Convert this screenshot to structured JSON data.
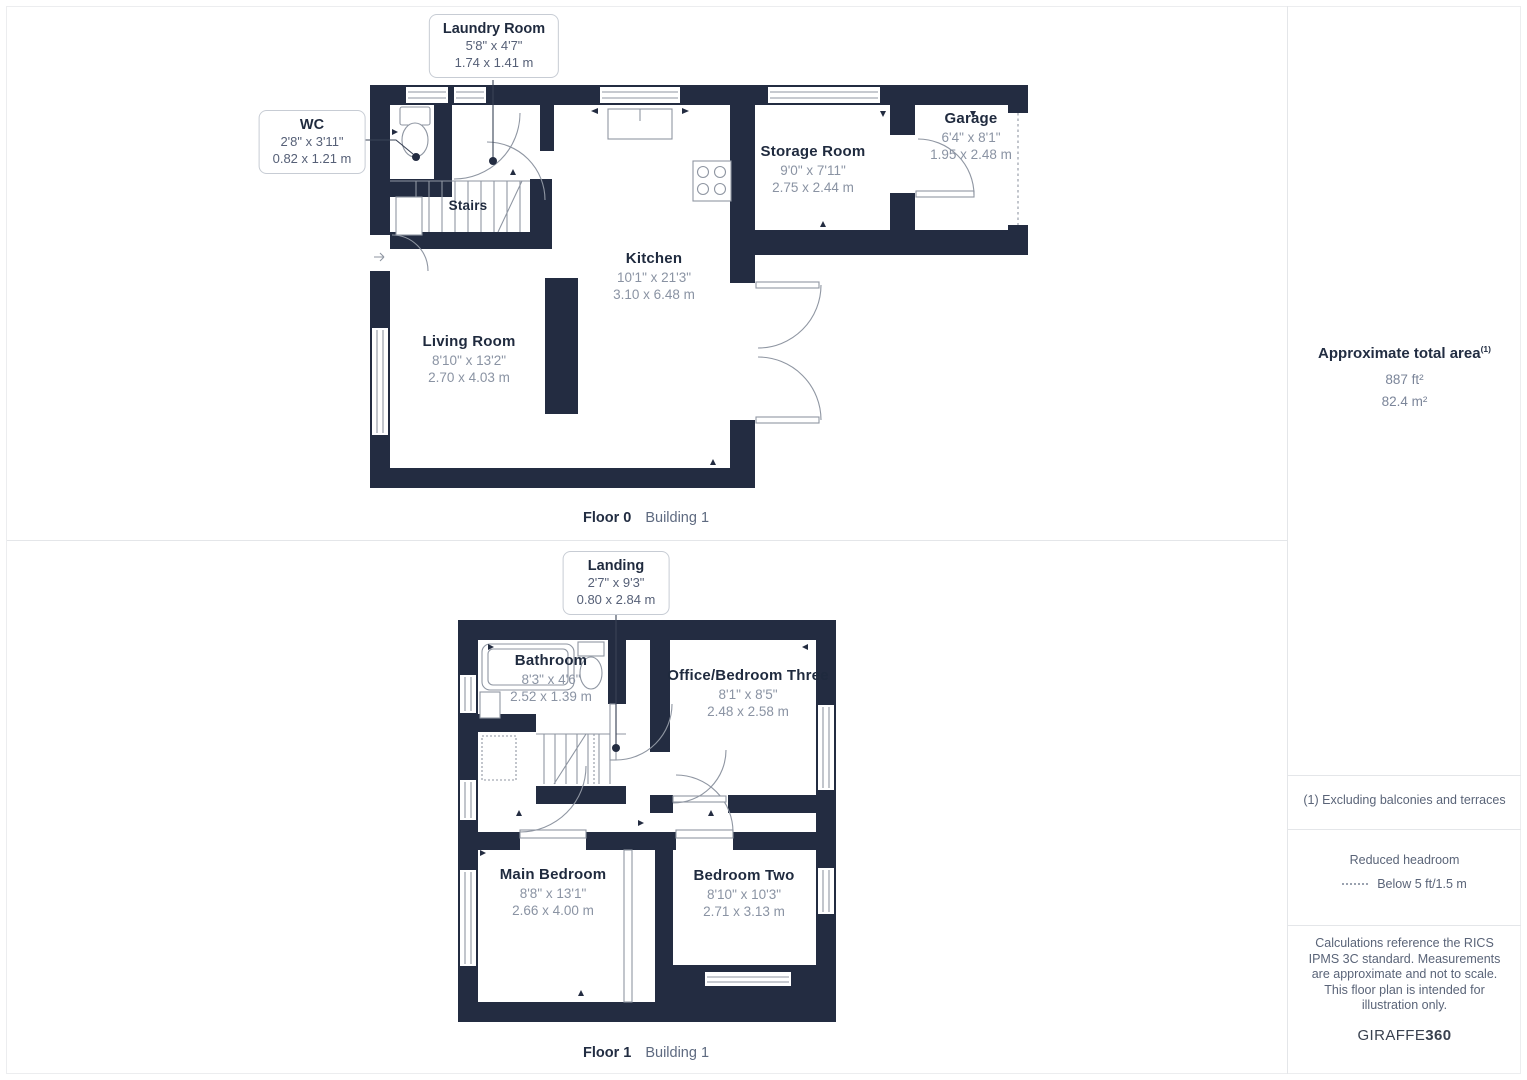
{
  "colors": {
    "wall": "#232C41",
    "line": "#8F96A2",
    "room_title": "#1F2A3E",
    "dimension_text": "#8A93A3"
  },
  "floor0": {
    "caption_floor": "Floor 0",
    "caption_building": "Building 1",
    "stairs_label": "Stairs",
    "rooms": {
      "kitchen": {
        "name": "Kitchen",
        "imperial": "10'1\" x 21'3\"",
        "metric": "3.10 x 6.48 m"
      },
      "storage_room": {
        "name": "Storage Room",
        "imperial": "9'0\" x 7'11\"",
        "metric": "2.75 x 2.44 m"
      },
      "garage": {
        "name": "Garage",
        "imperial": "6'4\" x 8'1\"",
        "metric": "1.95 x 2.48 m"
      },
      "living_room": {
        "name": "Living Room",
        "imperial": "8'10\" x 13'2\"",
        "metric": "2.70 x 4.03 m"
      }
    },
    "callouts": {
      "laundry_room": {
        "name": "Laundry Room",
        "imperial": "5'8\" x 4'7\"",
        "metric": "1.74 x 1.41 m"
      },
      "wc": {
        "name": "WC",
        "imperial": "2'8\" x 3'11\"",
        "metric": "0.82 x 1.21 m"
      }
    }
  },
  "floor1": {
    "caption_floor": "Floor 1",
    "caption_building": "Building 1",
    "rooms": {
      "bathroom": {
        "name": "Bathroom",
        "imperial": "8'3\" x 4'6\"",
        "metric": "2.52 x 1.39 m"
      },
      "office_bedroom_three": {
        "name": "Office/Bedroom Three",
        "imperial": "8'1\" x 8'5\"",
        "metric": "2.48 x 2.58 m"
      },
      "main_bedroom": {
        "name": "Main Bedroom",
        "imperial": "8'8\" x 13'1\"",
        "metric": "2.66 x 4.00 m"
      },
      "bedroom_two": {
        "name": "Bedroom Two",
        "imperial": "8'10\" x 10'3\"",
        "metric": "2.71 x 3.13 m"
      }
    },
    "callouts": {
      "landing": {
        "name": "Landing",
        "imperial": "2'7\" x 9'3\"",
        "metric": "0.80 x 2.84 m"
      }
    }
  },
  "sidebar": {
    "area_title": "Approximate total area",
    "area_title_sup": "(1)",
    "area_imperial": "887 ft²",
    "area_metric": "82.4 m²",
    "footnote": "(1) Excluding balconies and terraces",
    "reduced_headroom_label": "Reduced headroom",
    "reduced_headroom_value": "Below 5 ft/1.5 m",
    "disclaimer": "Calculations reference the RICS IPMS 3C standard. Measurements are approximate and not to scale. This floor plan is intended for illustration only.",
    "brand_name": "GIRAFFE",
    "brand_suffix": "360"
  }
}
